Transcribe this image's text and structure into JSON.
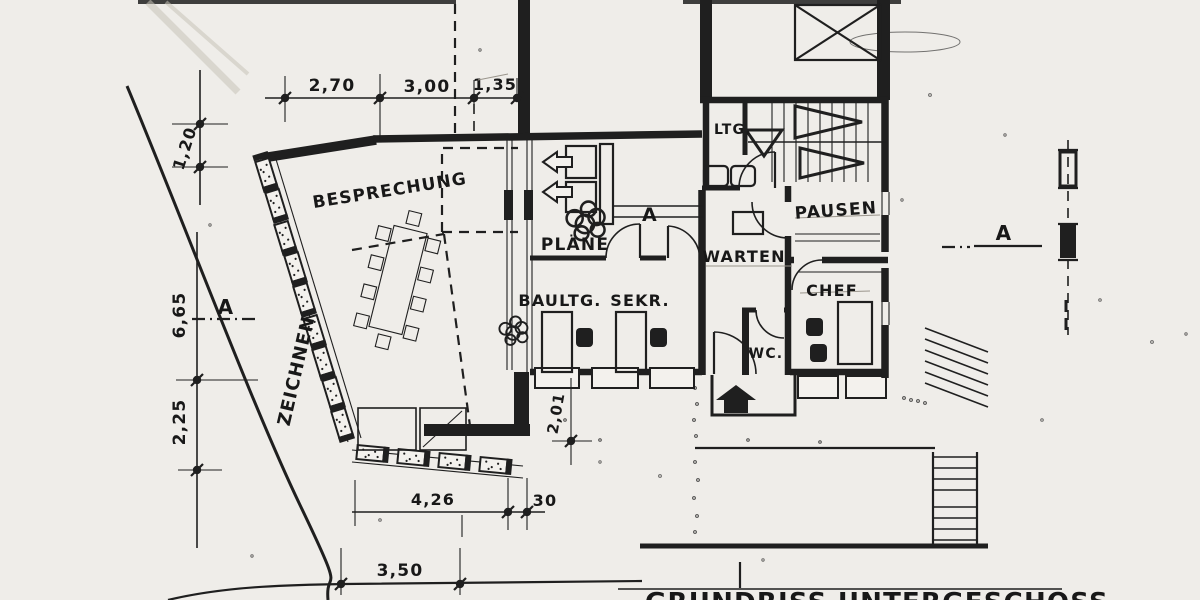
{
  "drawing": {
    "title": "GRUNDRISS UNTERGESCHOSS",
    "labels": {
      "besprechung": "BESPRECHUNG",
      "zeichnen": "ZEICHNEN",
      "plaene": "PLÄNE",
      "baultg": "BAULTG.",
      "sekr": "SEKR.",
      "warten": "WARTEN",
      "pausen": "PAUSEN",
      "chef": "CHEF",
      "wc": "WC.",
      "ltg": "LTG."
    },
    "dimensions": {
      "top": [
        "2,70",
        "3,00",
        "1,35"
      ],
      "left_upper": "1,20",
      "left_middle": "6,65",
      "left_lower": "2,25",
      "bottom_inner": "4,26",
      "bottom_inner_small": "30",
      "bottom_outer": "3,50",
      "entry": "2,01"
    },
    "section_marks": {
      "left": "A",
      "middle": "A",
      "right": "A"
    },
    "colors": {
      "ink": "#1f1f1f",
      "paper": "#efede9"
    }
  }
}
